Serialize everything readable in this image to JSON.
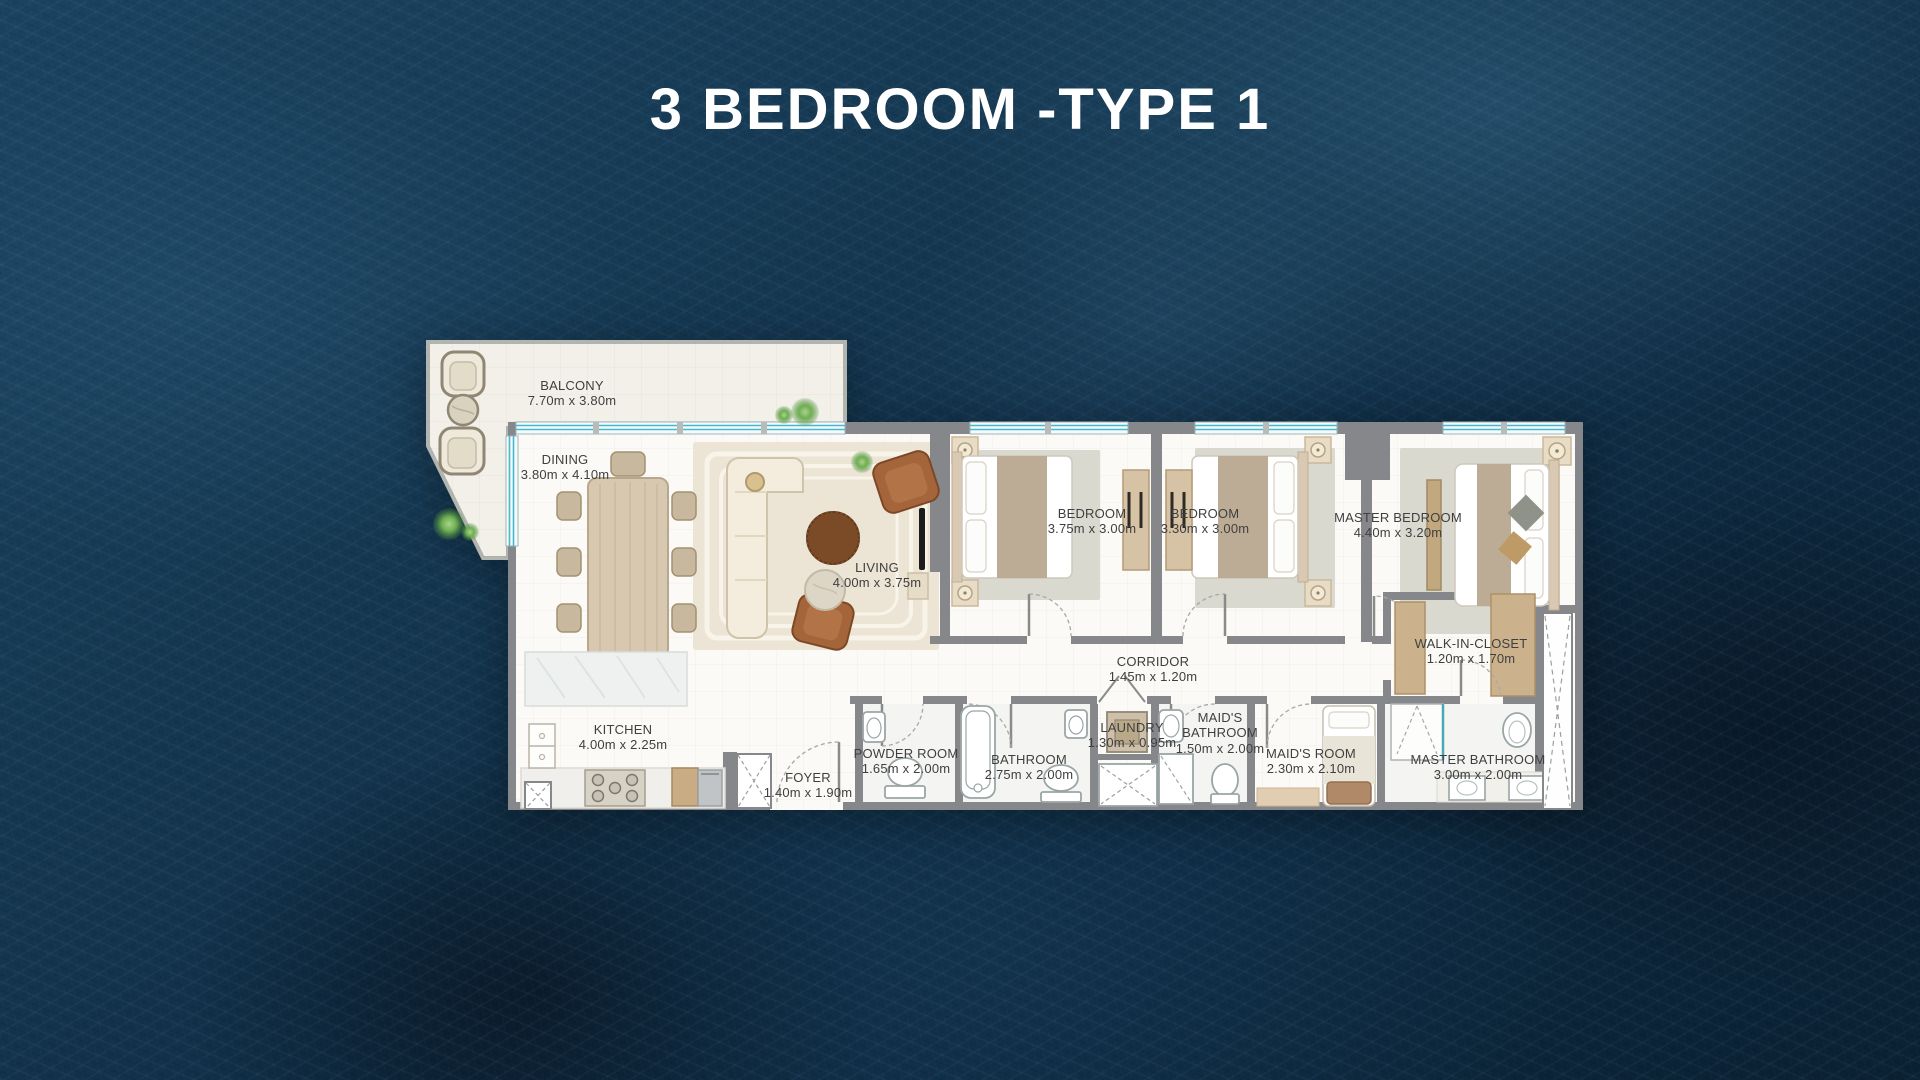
{
  "page": {
    "title": "3 BEDROOM -TYPE 1"
  },
  "floorplan": {
    "rooms": [
      {
        "name": "BALCONY",
        "dims": "7.70m x 3.80m"
      },
      {
        "name": "DINING",
        "dims": "3.80m x 4.10m"
      },
      {
        "name": "LIVING",
        "dims": "4.00m x 3.75m"
      },
      {
        "name": "BEDROOM",
        "dims": "3.75m x 3.00m"
      },
      {
        "name": "BEDROOM",
        "dims": "3.30m x 3.00m"
      },
      {
        "name": "MASTER BEDROOM",
        "dims": "4.40m x 3.20m"
      },
      {
        "name": "CORRIDOR",
        "dims": "1.45m x 1.20m"
      },
      {
        "name": "WALK-IN-CLOSET",
        "dims": "1.20m x 1.70m"
      },
      {
        "name": "KITCHEN",
        "dims": "4.00m x 2.25m"
      },
      {
        "name": "FOYER",
        "dims": "1.40m x 1.90m"
      },
      {
        "name": "POWDER ROOM",
        "dims": "1.65m x 2.00m"
      },
      {
        "name": "BATHROOM",
        "dims": "2.75m x 2.00m"
      },
      {
        "name": "LAUNDRY",
        "dims": "1.30m x 0.95m"
      },
      {
        "name": "MAID'S BATHROOM",
        "dims": "1.50m x 2.00m"
      },
      {
        "name": "MAID'S ROOM",
        "dims": "2.30m x 2.10m"
      },
      {
        "name": "MASTER BATHROOM",
        "dims": "3.00m x 2.00m"
      }
    ]
  },
  "colors": {
    "background": "#0f2940",
    "title_text": "#ffffff",
    "wall": "#85878a",
    "floor": "#fbfaf6",
    "balcony_floor": "#f2f0e9",
    "window_glass": "#49b8cc",
    "label_text": "#3f3f3f",
    "wood": "#d6c2a4",
    "rug": "#d9d9cf"
  }
}
